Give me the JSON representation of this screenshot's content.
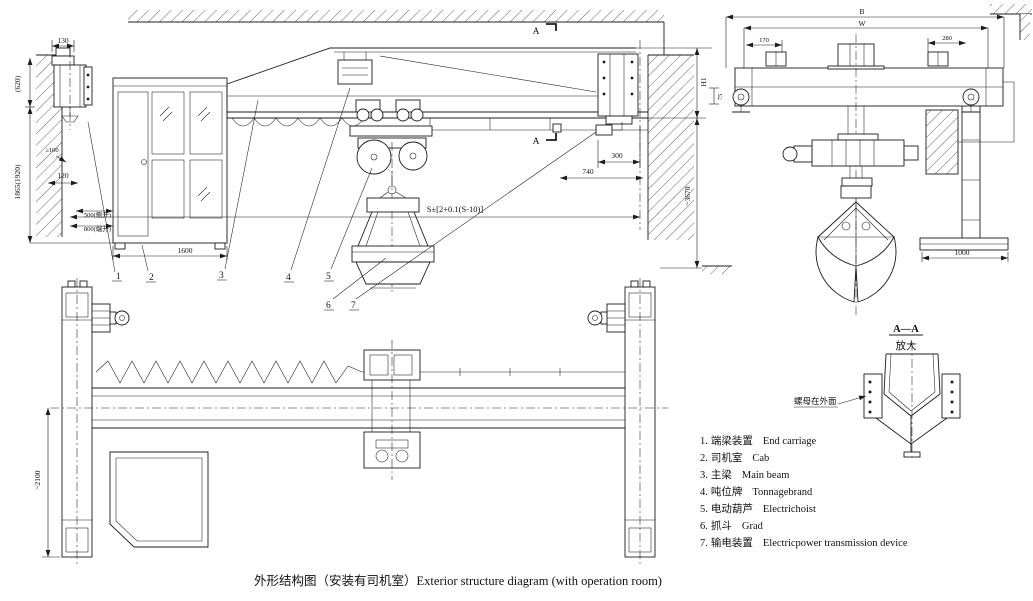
{
  "caption": "外形结构图（安装有司机室）Exterior structure diagram (with operation room)",
  "legend": [
    {
      "num": "1.",
      "zh": "端梁装置",
      "en": "End carriage"
    },
    {
      "num": "2.",
      "zh": "司机室",
      "en": "Cab"
    },
    {
      "num": "3.",
      "zh": "主梁",
      "en": "Main beam"
    },
    {
      "num": "4.",
      "zh": "吨位牌",
      "en": "Tonnagebrand"
    },
    {
      "num": "5.",
      "zh": "电动葫芦",
      "en": "Electrichoist"
    },
    {
      "num": "6.",
      "zh": "抓斗",
      "en": "Grad"
    },
    {
      "num": "7.",
      "zh": "输电装置",
      "en": "Electricpower transmission device"
    }
  ],
  "detail_view": {
    "title": "A—A",
    "subtitle": "放大",
    "note": "螺母在外面"
  },
  "elevation": {
    "section_marker": "A",
    "dims": {
      "d130": "130",
      "d620": "(620)",
      "dmin100": "≥100",
      "d120": "120",
      "d1865": "1865(1920)",
      "d500": "500(侧开)",
      "d800": "800(端开)",
      "d1600": "1600",
      "d300": "300",
      "d740": "740",
      "dS": "S±[2+0.1(S-10)]",
      "dH1": "H1",
      "d3670": "~3670",
      "d75": "75"
    },
    "callouts": [
      "1",
      "2",
      "3",
      "4",
      "5",
      "6",
      "7"
    ]
  },
  "plan": {
    "dims": {
      "d2100": "~2100"
    }
  },
  "side_view": {
    "dims": {
      "dB": "B",
      "dW": "W",
      "d170": "170",
      "d280": "280",
      "d1000": "1000"
    }
  }
}
